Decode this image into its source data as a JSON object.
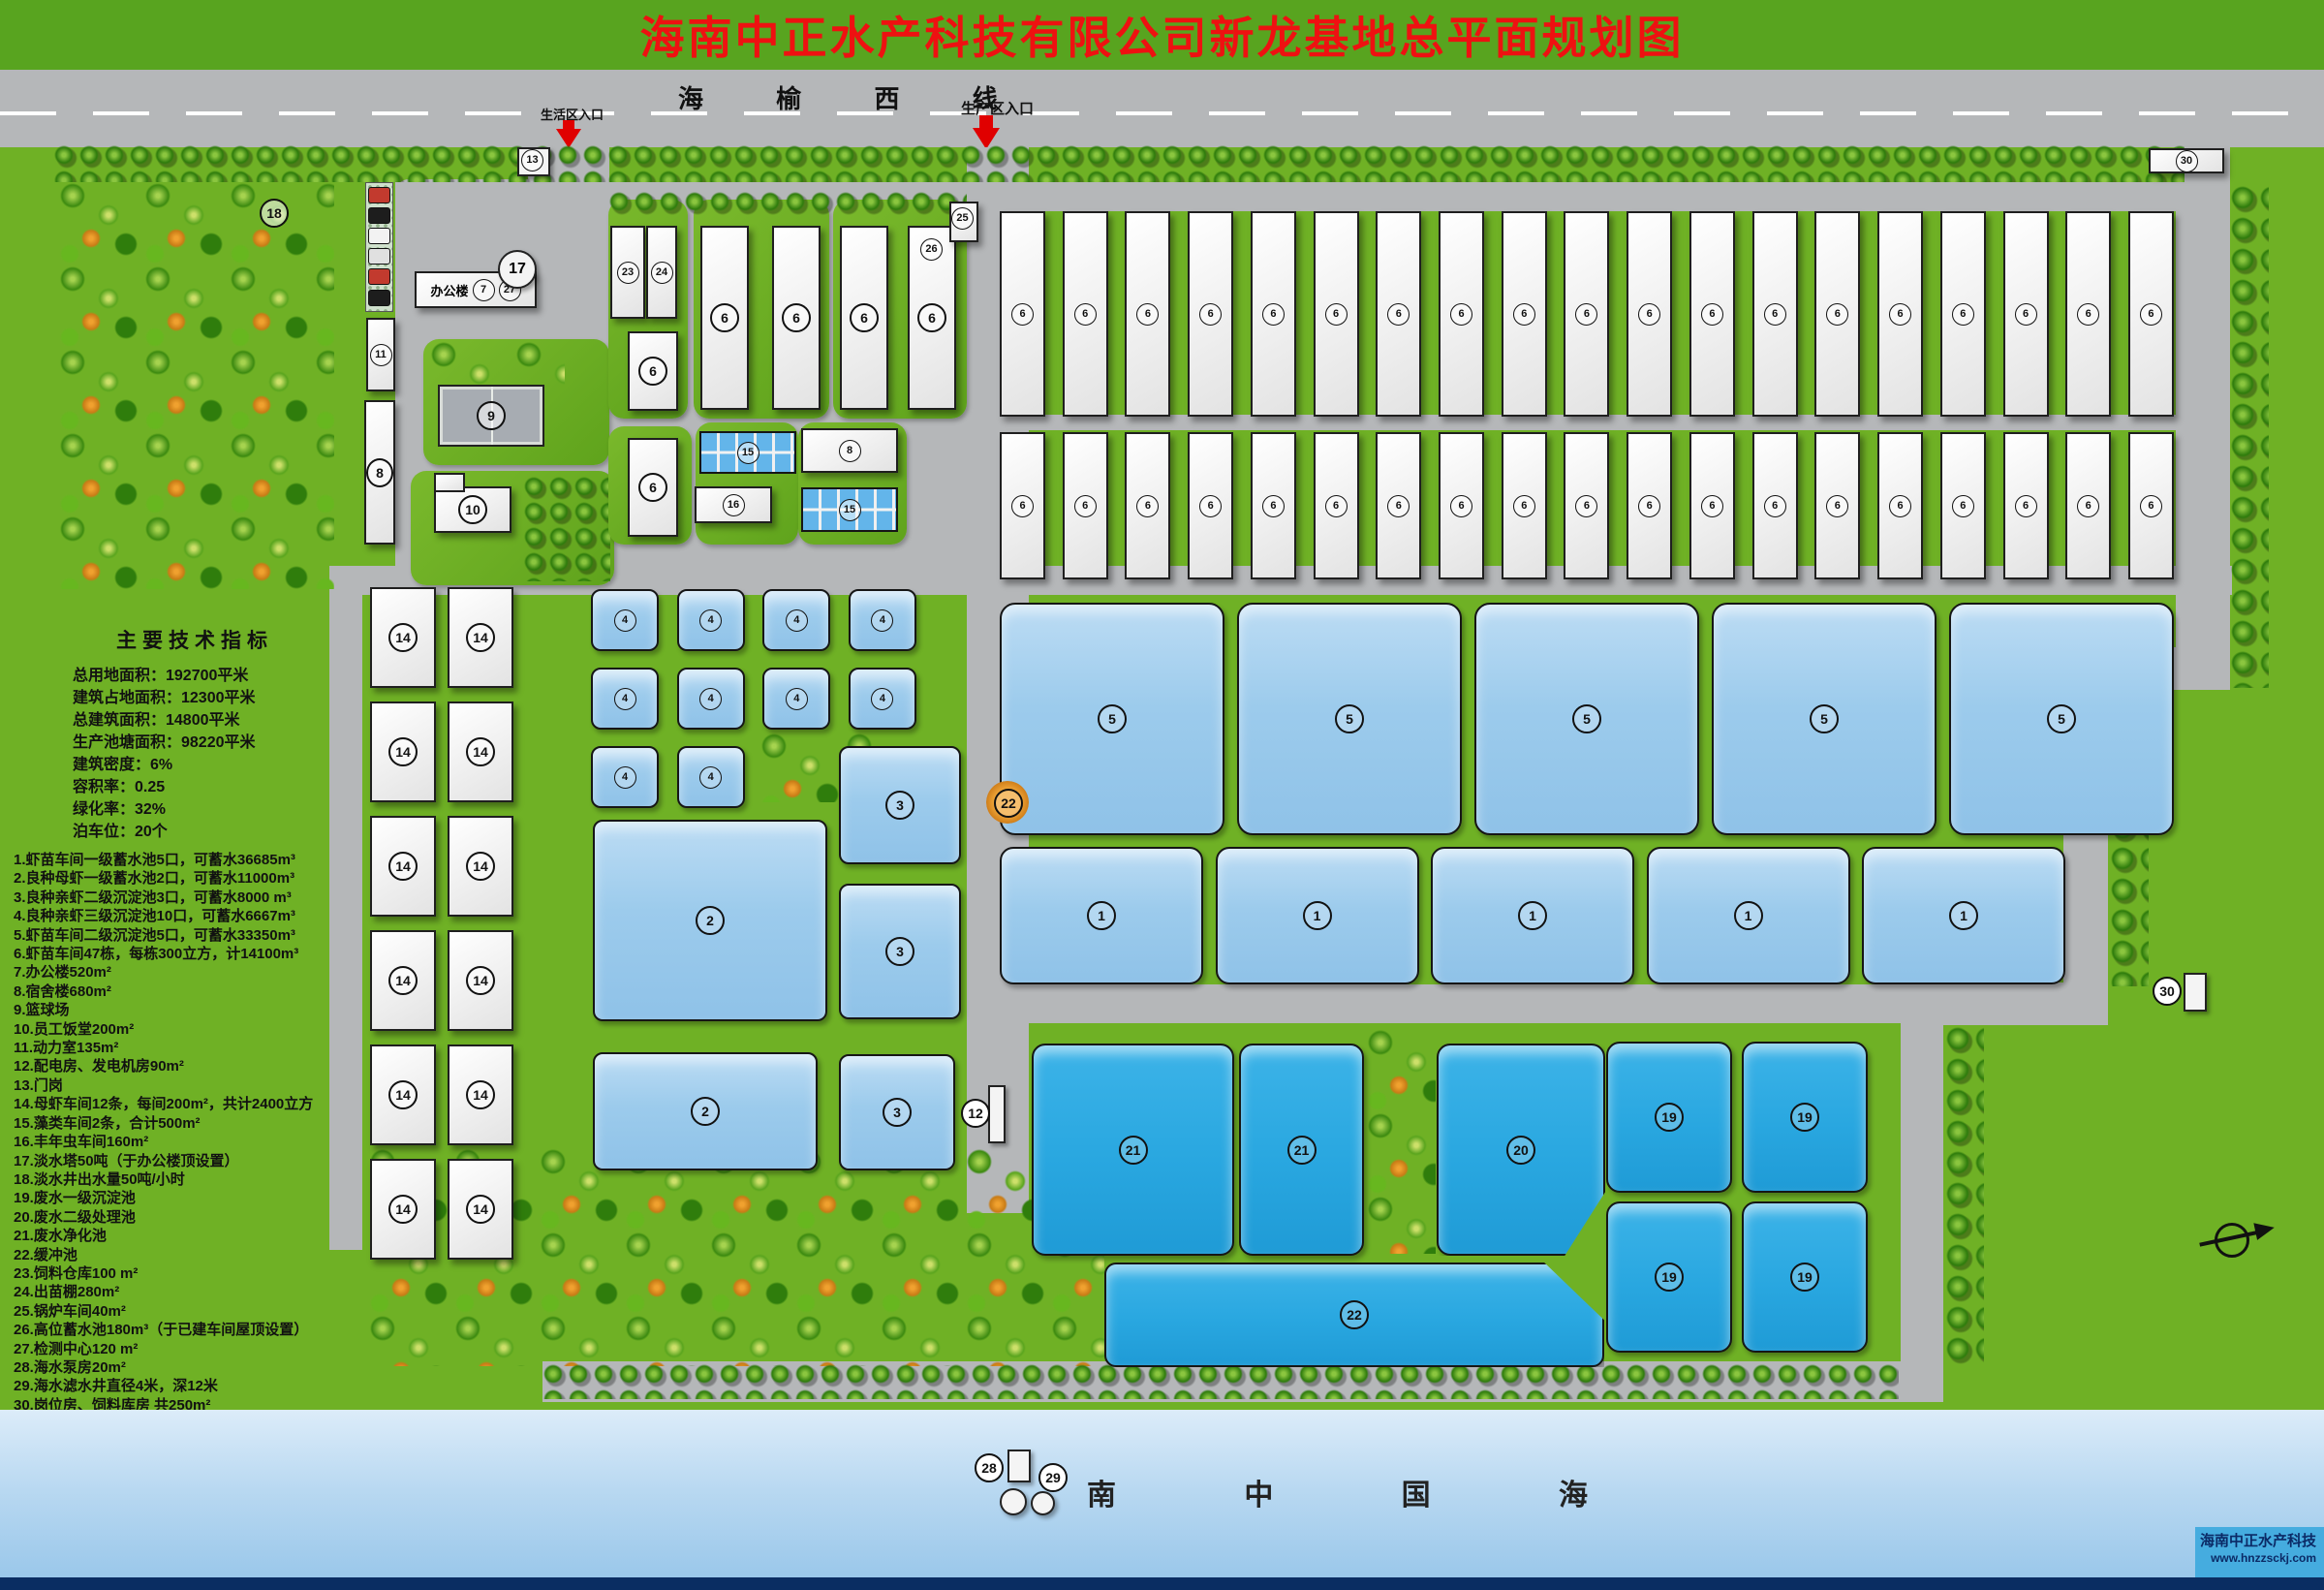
{
  "title": "海南中正水产科技有限公司新龙基地总平面规划图",
  "road": {
    "name": "海 榆 西 线",
    "entrance_living": "生活区入口",
    "entrance_production": "生产区入口"
  },
  "indicators": {
    "title": "主要技术指标",
    "lines": [
      "总用地面积：192700平米",
      "建筑占地面积：12300平米",
      "总建筑面积：14800平米",
      "生产池塘面积：98220平米",
      "建筑密度：6%",
      "容积率：0.25",
      "绿化率：32%",
      "泊车位：20个"
    ]
  },
  "legend": {
    "items": [
      "1.虾苗车间一级蓄水池5口，可蓄水36685m³",
      "2.良种母虾一级蓄水池2口，可蓄水11000m³",
      "3.良种亲虾二级沉淀池3口，可蓄水8000 m³",
      "4.良种亲虾三级沉淀池10口，可蓄水6667m³",
      "5.虾苗车间二级沉淀池5口，可蓄水33350m³",
      "6.虾苗车间47栋，每栋300立方，计14100m³",
      "7.办公楼520m²",
      "8.宿舍楼680m²",
      "9.篮球场",
      "10.员工饭堂200m²",
      "11.动力室135m²",
      "12.配电房、发电机房90m²",
      "13.门岗",
      "14.母虾车间12条，每间200m²，共计2400立方",
      "15.藻类车间2条，合计500m²",
      "16.丰年虫车间160m²",
      "17.淡水塔50吨（于办公楼顶设置）",
      "18.淡水井出水量50吨/小时",
      "19.废水一级沉淀池",
      "20.废水二级处理池",
      "21.废水净化池",
      "22.缓冲池",
      "23.饲料仓库100 m²",
      "24.出苗棚280m²",
      "25.锅炉车间40m²",
      "26.高位蓄水池180m³（于已建车间屋顶设置）",
      "27.检测中心120 m²",
      "28.海水泵房20m²",
      "29.海水滤水井直径4米，深12米",
      "30.岗位房、饲料库房 共250m²"
    ]
  },
  "plan": {
    "office_name": "办公楼",
    "labels": {
      "n6": "6",
      "n7": "7",
      "n8": "8",
      "n9": "9",
      "n10": "10",
      "n11": "11",
      "n12": "12",
      "n13": "13",
      "n15": "15",
      "n16": "16",
      "n17": "17",
      "n18": "18",
      "n20": "20",
      "n22": "22",
      "n23": "23",
      "n24": "24",
      "n25": "25",
      "n26": "26",
      "n27": "27",
      "n28": "28",
      "n29": "29",
      "n30": "30"
    },
    "groups": {
      "six_top": {
        "label": "6",
        "count": 19
      },
      "six_bottom": {
        "label": "6",
        "count": 19
      },
      "five": {
        "label": "5",
        "count": 5
      },
      "one": {
        "label": "1",
        "count": 5
      },
      "fourteen": {
        "label": "14",
        "count": 12
      },
      "four": {
        "label": "4",
        "count": 10
      },
      "three": {
        "label": "3",
        "count": 3
      },
      "two": {
        "label": "2",
        "count": 2
      },
      "nineteen": {
        "label": "19",
        "count": 4
      },
      "twentyone": {
        "label": "21",
        "count": 2
      }
    }
  },
  "sea": {
    "name": "南 中 国 海"
  },
  "watermark": {
    "company": "海南中正水产科技",
    "url": "www.hnzzsckj.com"
  }
}
